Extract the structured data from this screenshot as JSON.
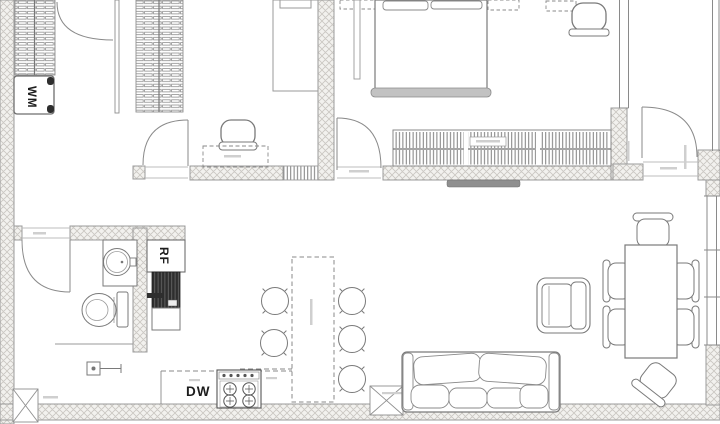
{
  "plan": {
    "type": "apartment-floor-plan",
    "labels": {
      "washing_machine": "WM",
      "refrigerator": "RF",
      "dishwasher": "DW"
    },
    "colors": {
      "background": "#ffffff",
      "line": "#7a7a7a",
      "wall_fill": "#f2f1ee",
      "wall_hatch": "#c9c6c1",
      "wall_edge": "#9b9b9b",
      "dark_appliance": "#2e2e2e",
      "tv_bar": "#8f8f8f",
      "bed_footboard": "#c2c2c2",
      "micro_label": "#cfcfcf",
      "label_text": "#1c1c1c"
    }
  }
}
